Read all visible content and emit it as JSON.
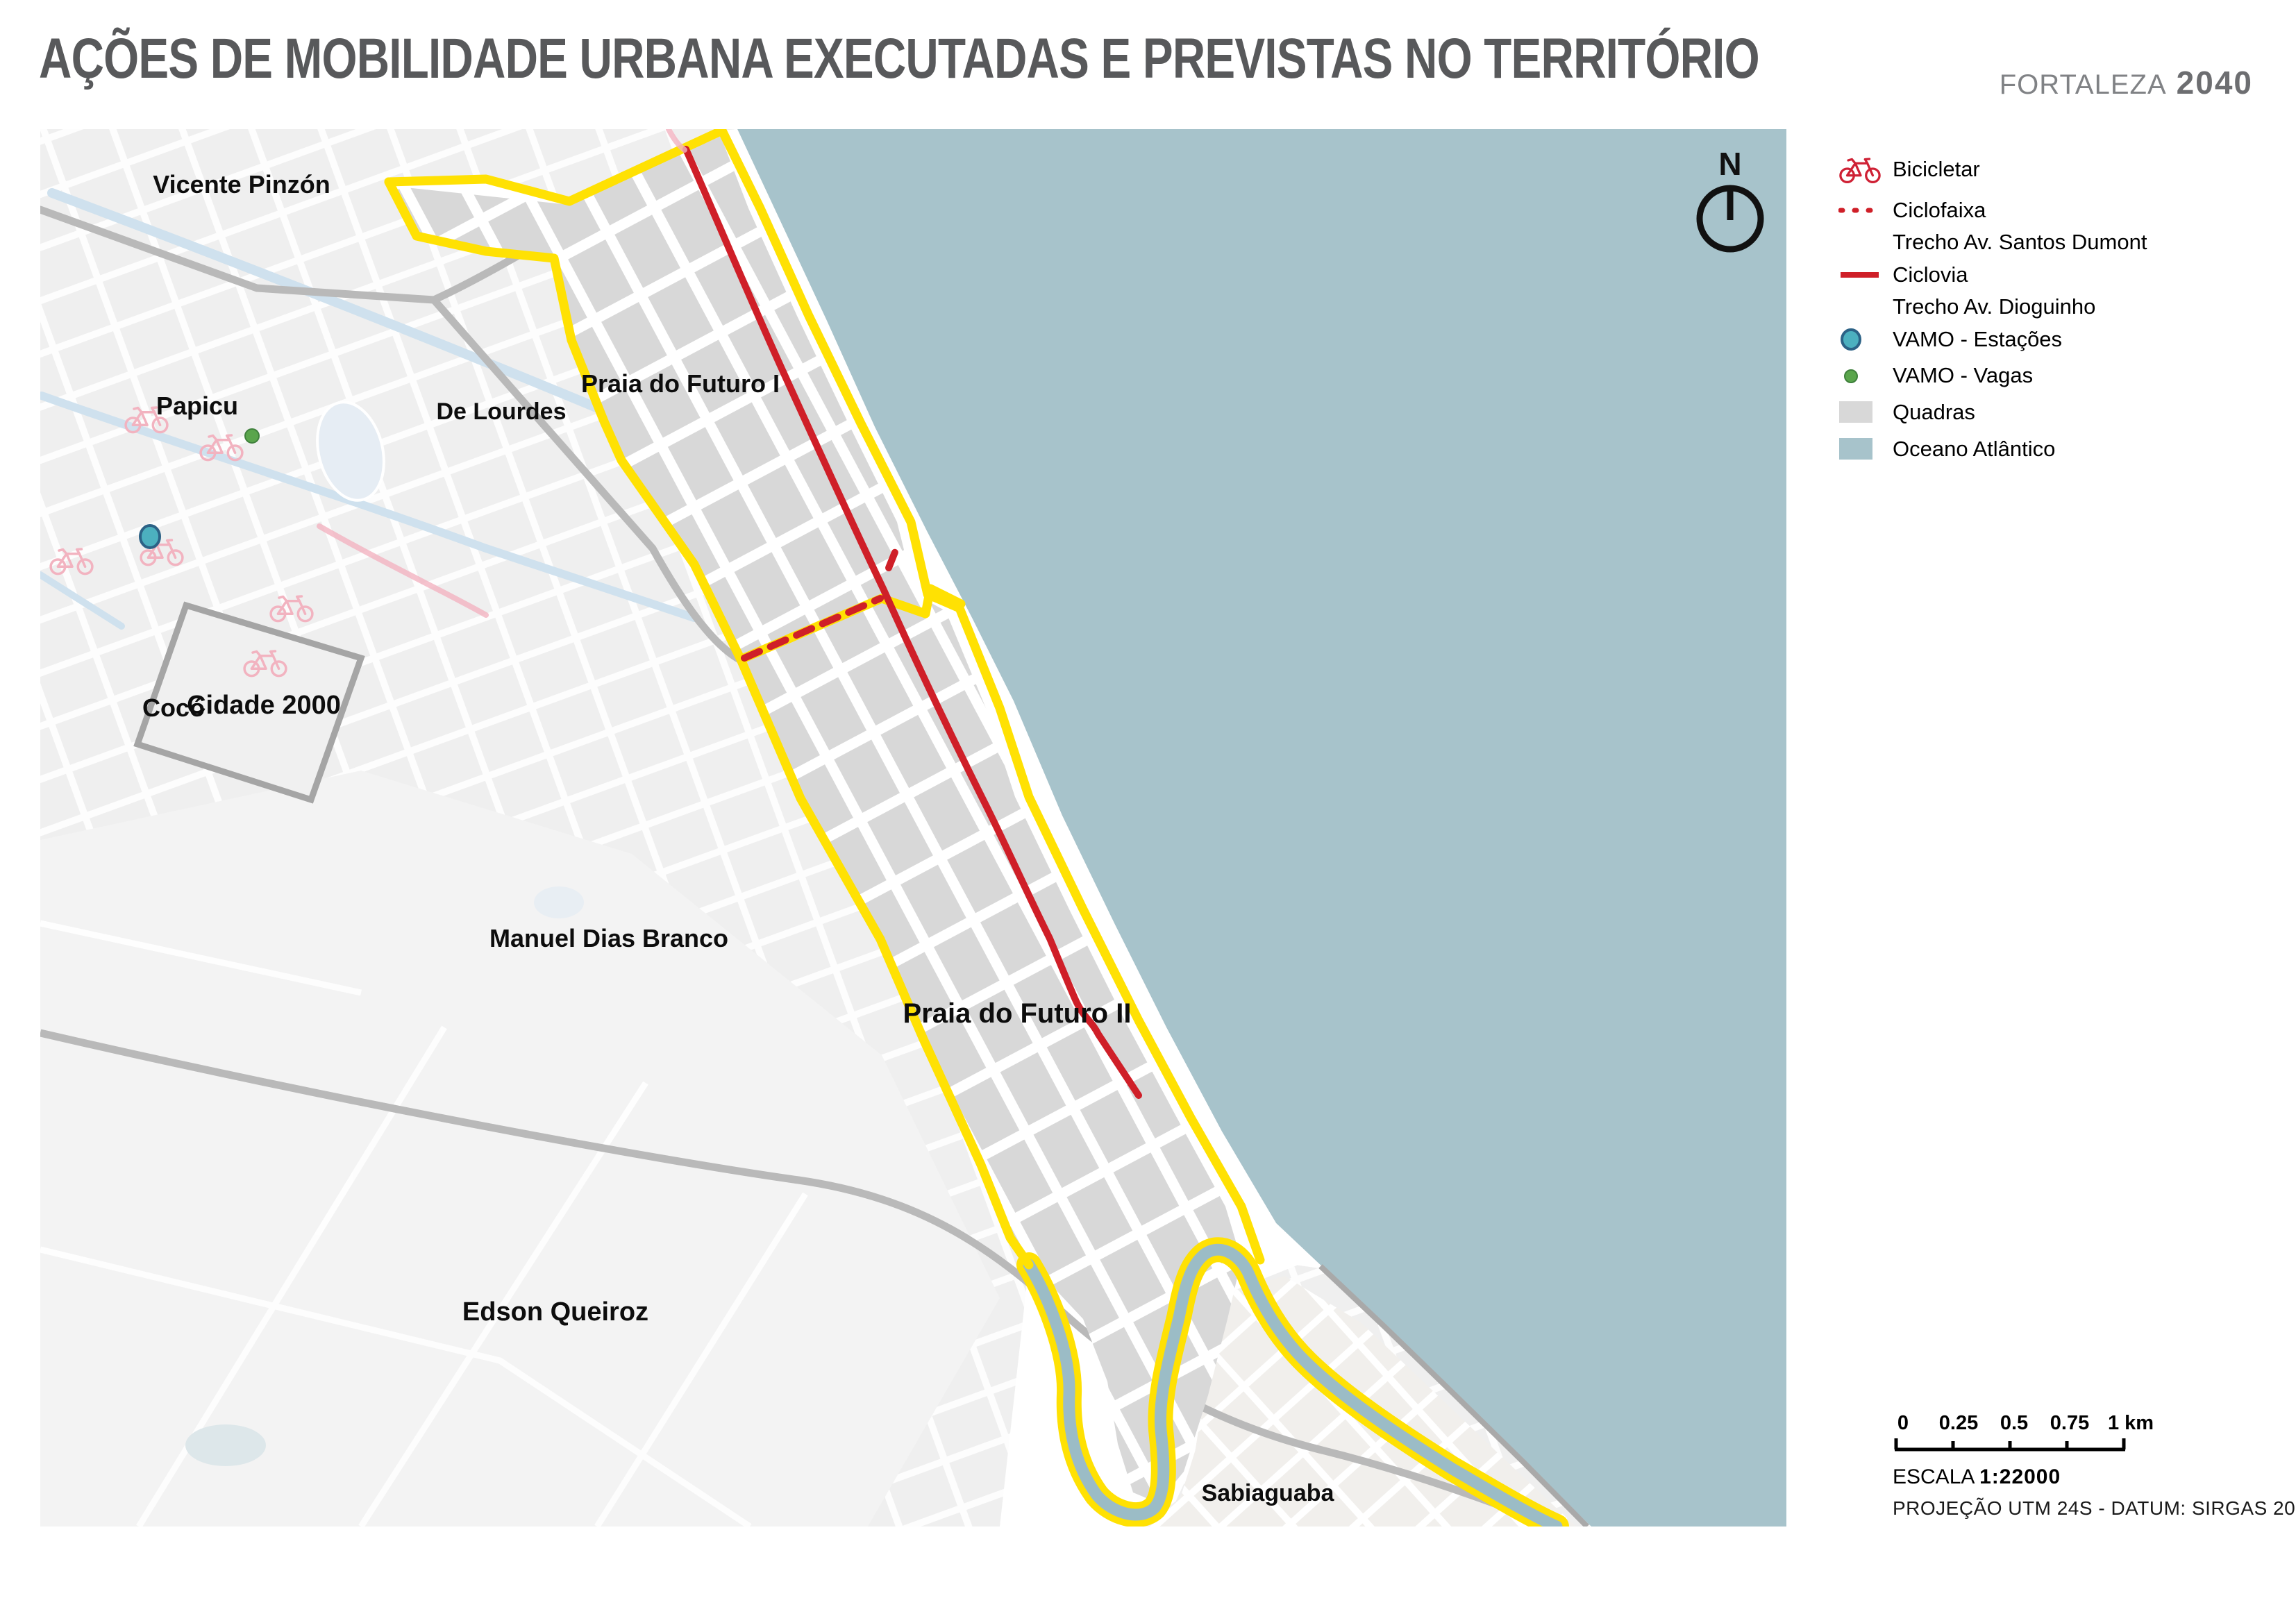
{
  "header": {
    "title": "AÇÕES DE MOBILIDADE URBANA EXECUTADAS E PREVISTAS NO TERRITÓRIO",
    "brand_name": "FORTALEZA",
    "brand_year": "2040"
  },
  "legend": {
    "items": [
      {
        "id": "bicicletar",
        "label": "Bicicletar"
      },
      {
        "id": "ciclofaixa",
        "label": "Ciclofaixa",
        "sublabel": "Trecho Av. Santos Dumont"
      },
      {
        "id": "ciclovia",
        "label": "Ciclovia",
        "sublabel": "Trecho Av. Dioguinho"
      },
      {
        "id": "vamo-estacoes",
        "label": "VAMO - Estações"
      },
      {
        "id": "vamo-vagas",
        "label": "VAMO - Vagas"
      },
      {
        "id": "quadras",
        "label": "Quadras"
      },
      {
        "id": "oceano",
        "label": "Oceano Atlântico"
      }
    ]
  },
  "map": {
    "north_label": "N",
    "labels": [
      {
        "id": "vicente-pinzon",
        "text": "Vicente Pinzón"
      },
      {
        "id": "papicu",
        "text": "Papicu"
      },
      {
        "id": "de-lourdes",
        "text": "De Lourdes"
      },
      {
        "id": "praia-do-futuro-i",
        "text": "Praia do Futuro I"
      },
      {
        "id": "coco",
        "text": "Cocó"
      },
      {
        "id": "cidade-2000",
        "text": "Cidade 2000"
      },
      {
        "id": "manuel-dias-branco",
        "text": "Manuel Dias Branco"
      },
      {
        "id": "praia-do-futuro-ii",
        "text": "Praia do Futuro II"
      },
      {
        "id": "edson-queiroz",
        "text": "Edson Queiroz"
      },
      {
        "id": "sabiaguaba",
        "text": "Sabiaguaba"
      }
    ]
  },
  "scale_bar": {
    "ticks": [
      "0",
      "0.25",
      "0.5",
      "0.75",
      "1 km"
    ],
    "escala_label": "ESCALA",
    "escala_value": "1:22000",
    "projection": "PROJEÇÃO UTM 24S - DATUM: SIRGAS 2000"
  },
  "colors": {
    "territory_boundary_yellow": "#ffe103",
    "ciclovia_red": "#cf1f28",
    "bicicletar_pink": "#f2b3c0",
    "bicicletar_legend_red": "#cf2135",
    "vamo_station_teal": "#4cb0bf",
    "vamo_station_border": "#2c6286",
    "vamo_vaga_green": "#5aa54c",
    "quadras_gray": "#d8d8d8",
    "ocean_blue": "#a7c3cb",
    "title_gray": "#58595b"
  }
}
